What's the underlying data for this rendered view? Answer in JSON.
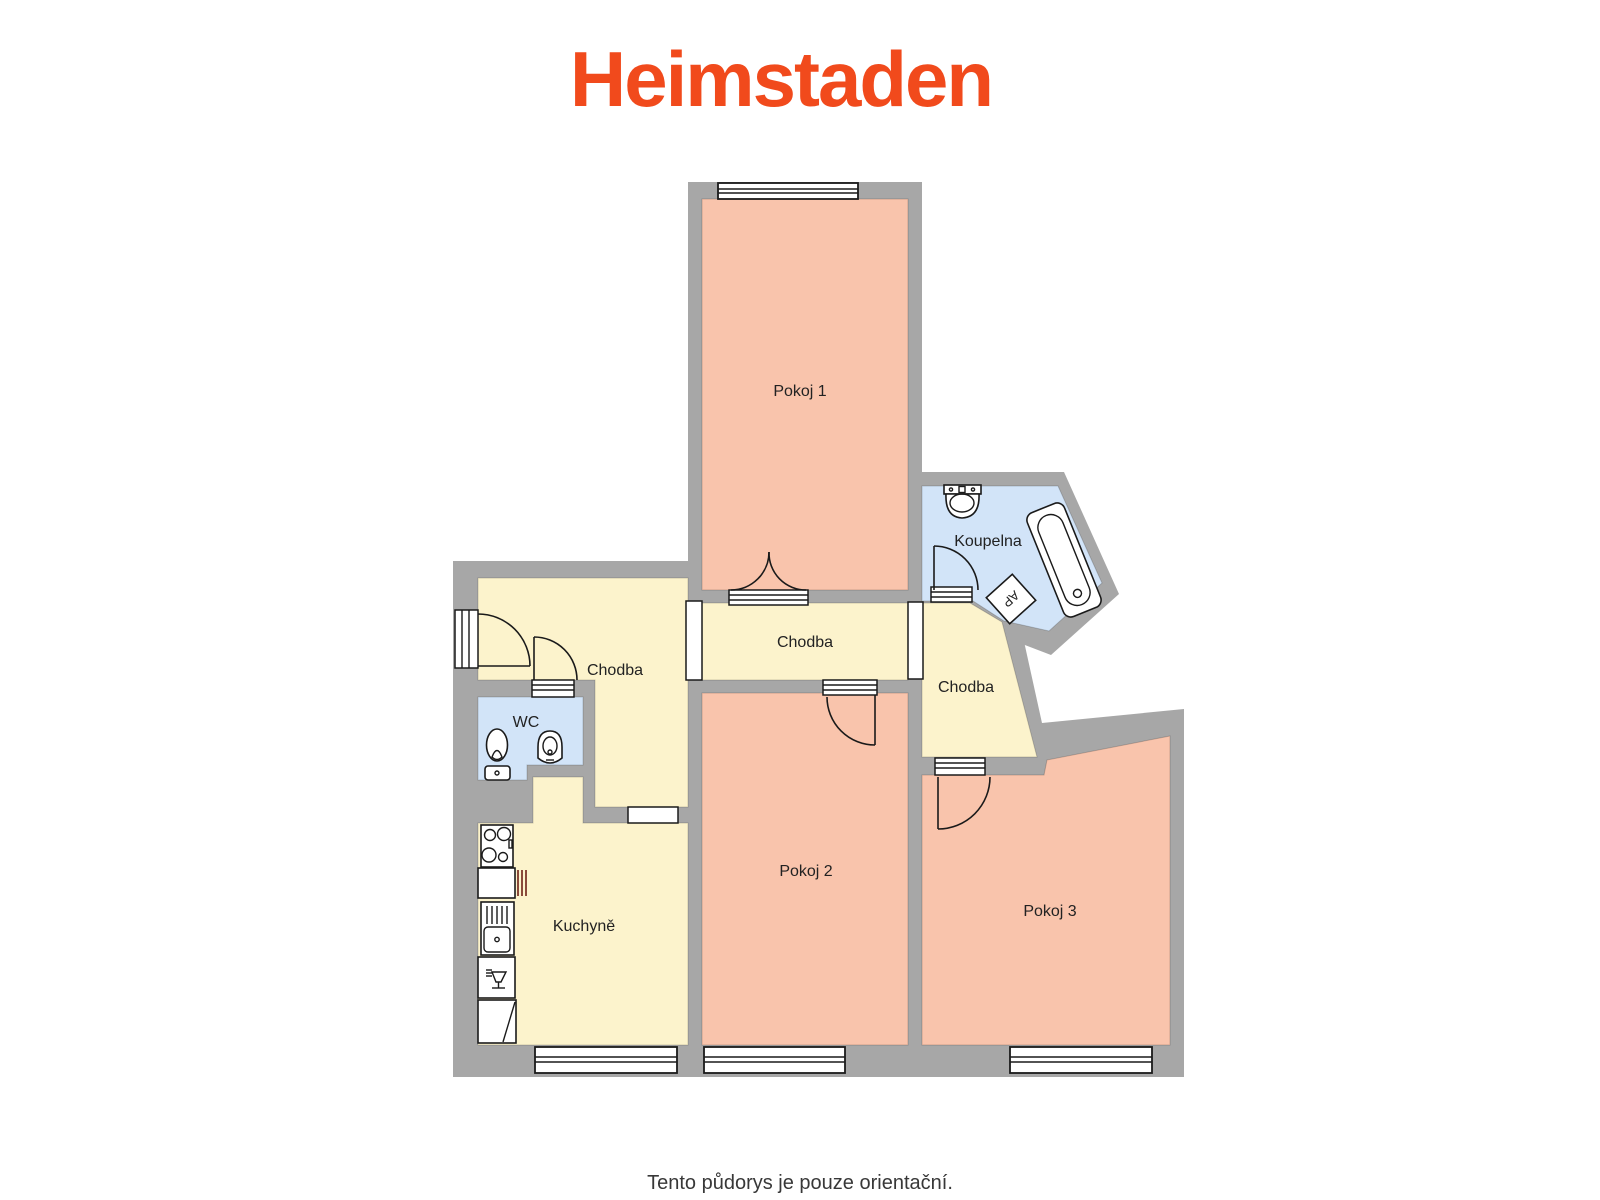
{
  "logo": {
    "text": "Heimstaden",
    "color": "#F14A1C"
  },
  "footer": {
    "disclaimer": "Tento půdorys je pouze orientační."
  },
  "floorplan": {
    "colors": {
      "wall": "#A7A7A7",
      "room": "#F9C4AC",
      "hallway": "#FCF3CC",
      "sanitary": "#D2E4F8",
      "fixture": "#FFFFFF"
    },
    "labels": {
      "pokoj1": "Pokoj 1",
      "pokoj2": "Pokoj 2",
      "pokoj3": "Pokoj 3",
      "kuchyne": "Kuchyně",
      "koupelna": "Koupelna",
      "wc": "WC",
      "chodba_left": "Chodba",
      "chodba_middle": "Chodba",
      "chodba_right": "Chodba",
      "ap": "AP"
    }
  }
}
